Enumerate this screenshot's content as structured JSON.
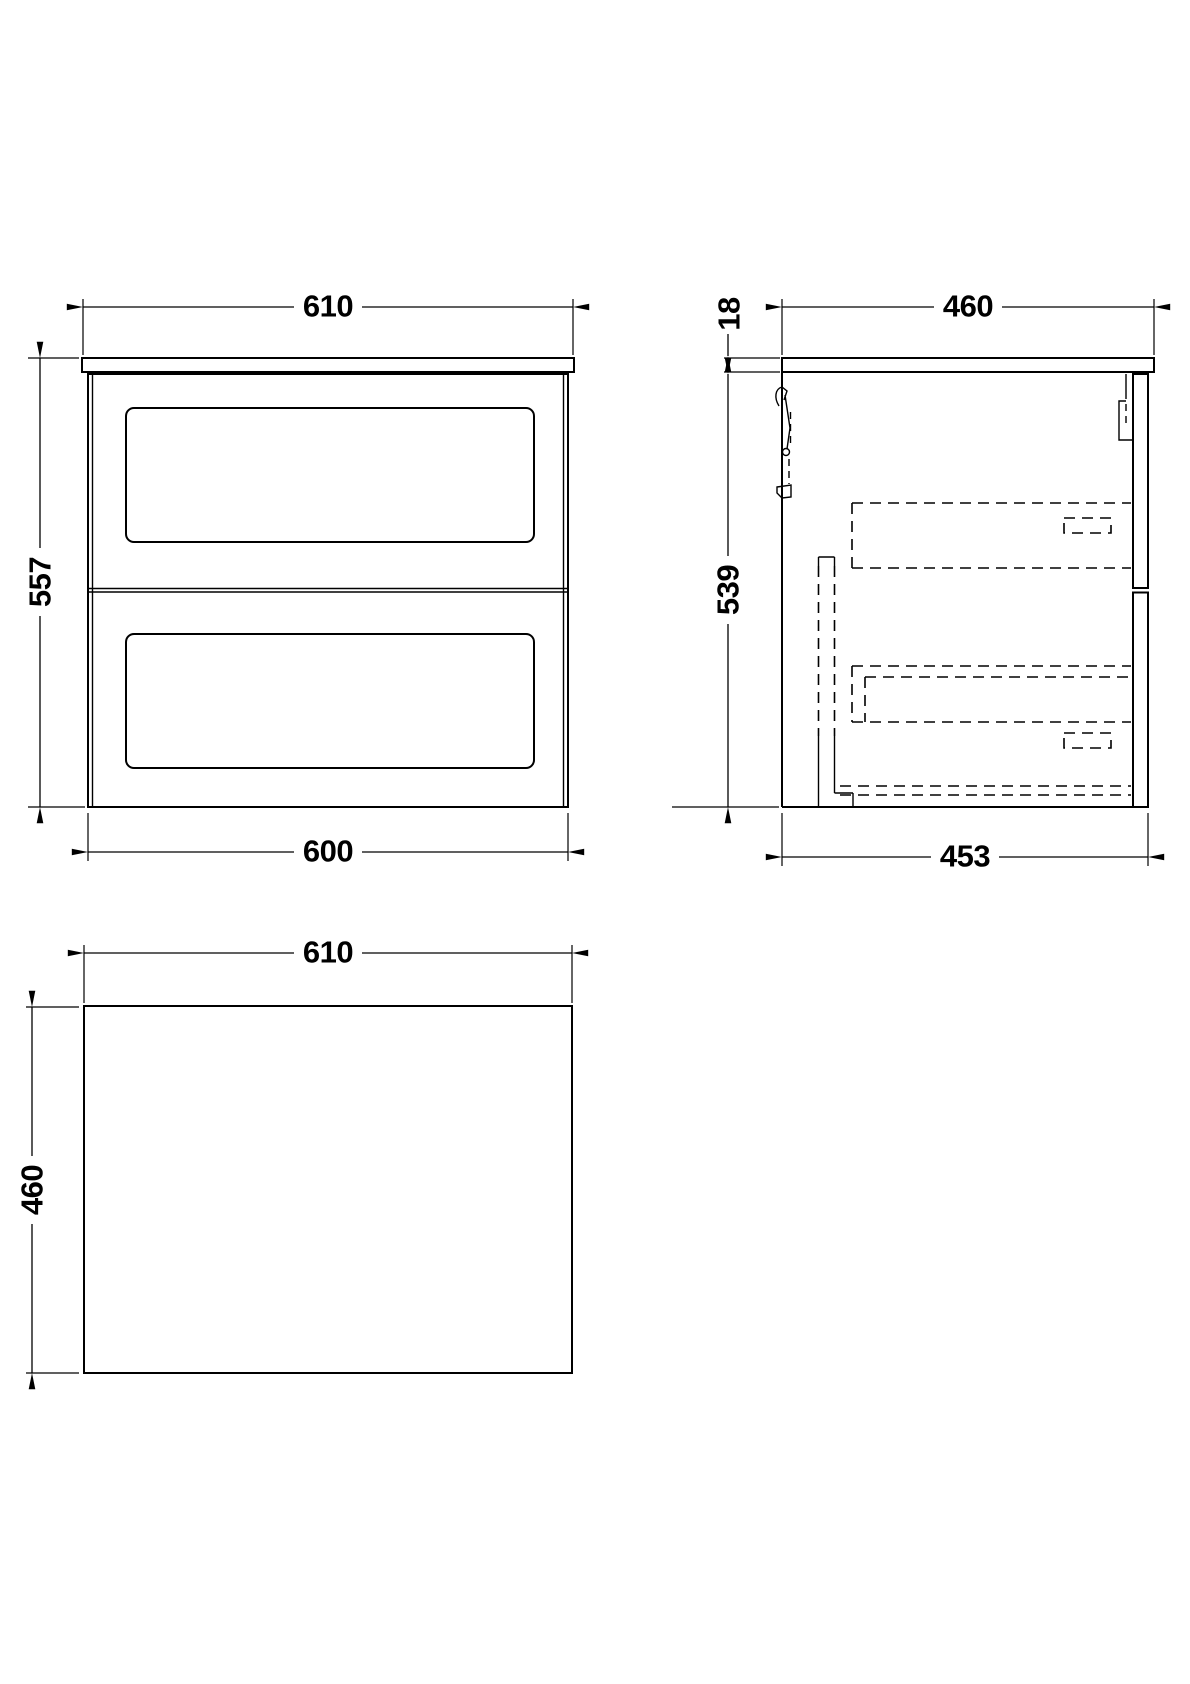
{
  "drawing": {
    "background_color": "#ffffff",
    "line_color": "#000000",
    "views": {
      "front": {
        "dims": {
          "width_top": "610",
          "height_left": "557",
          "width_bottom": "600"
        }
      },
      "side": {
        "dims": {
          "depth_top": "460",
          "worktop_thickness": "18",
          "height_left": "539",
          "depth_bottom": "453"
        }
      },
      "plan": {
        "dims": {
          "width_top": "610",
          "depth_left": "460"
        }
      }
    }
  }
}
